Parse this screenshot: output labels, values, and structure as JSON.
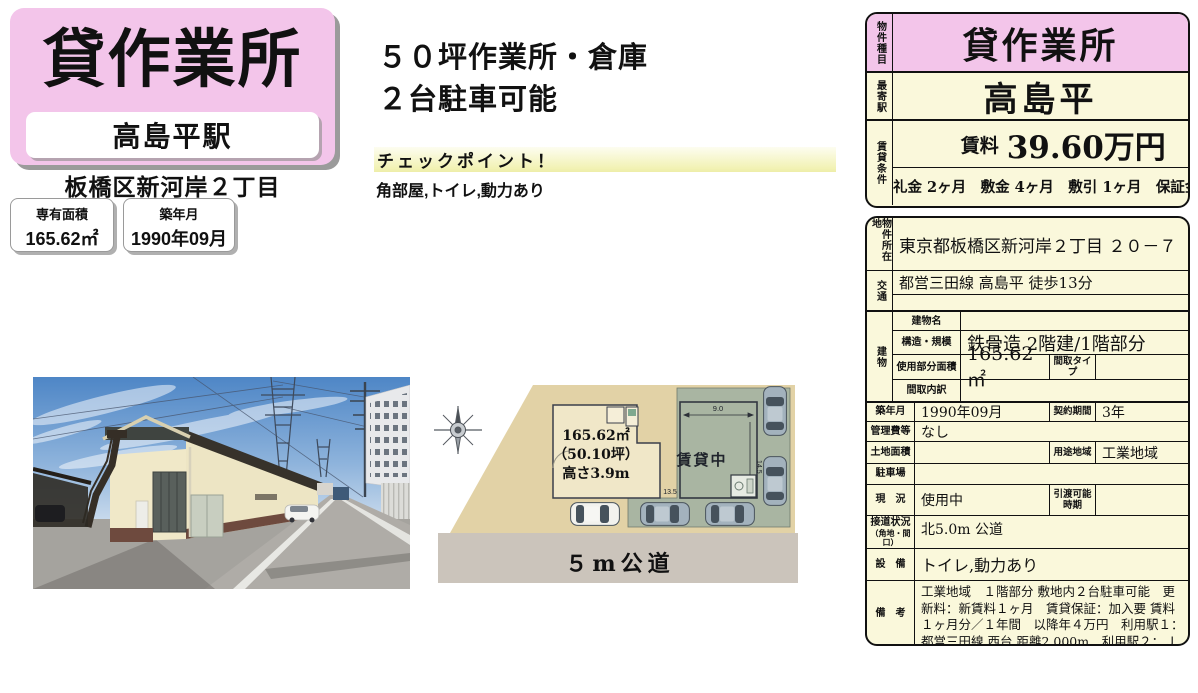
{
  "colors": {
    "pink": "#F3C5EA",
    "cream": "#FAF8DB",
    "checkpoint_yellow": "#F2F2B4",
    "lot_tan": "#E2D2A6",
    "building_green": "#A9B5A2",
    "road_gray": "#CBC4BB"
  },
  "header": {
    "property_type": "貸作業所",
    "station": "高島平駅",
    "address_short": "板橋区新河岸２丁目",
    "area_card": {
      "label": "専有面積",
      "value": "165.62㎡"
    },
    "built_card": {
      "label": "築年月",
      "value": "1990年09月"
    }
  },
  "highlights": {
    "line1": "５０坪作業所・倉庫",
    "line2": "２台駐車可能",
    "checkpoint_title": "チェックポイント！",
    "checkpoint_text": "角部屋,トイレ,動力あり"
  },
  "summary_table": {
    "property_type_label": "物件種目",
    "property_type": "貸作業所",
    "station_label": "最寄駅",
    "station": "高島平",
    "terms_label": "賃貸条件",
    "rent_label": "賃料",
    "rent_value": "39.60万円",
    "terms": "礼金 2ヶ月　敷金 4ヶ月　敷引 1ヶ月　保証金 なし"
  },
  "detail_table": {
    "location": {
      "label": "物件所在地",
      "value": "東京都板橋区新河岸２丁目 ２０－７"
    },
    "access": {
      "label": "交通",
      "value": "都営三田線 高島平 徒歩13分"
    },
    "building": {
      "label": "建物",
      "name_label": "建物名",
      "name": "",
      "structure_label": "構造・規模",
      "structure": "鉄骨造 2階建/1階部分",
      "used_area_label": "使用部分面積",
      "used_area": "165.62㎡",
      "layout_type_label": "間取タイプ",
      "layout_type": "",
      "layout_detail_label": "間取内訳",
      "layout_detail": ""
    },
    "built": {
      "label": "築年月",
      "value": "1990年09月",
      "label2": "契約期間",
      "value2": "3年"
    },
    "management": {
      "label": "管理費等",
      "value": "なし"
    },
    "land": {
      "label": "土地面積",
      "value": "",
      "label2": "用途地域",
      "value2": "工業地域"
    },
    "parking": {
      "label": "駐車場",
      "value": ""
    },
    "status": {
      "label": "現　況",
      "value": "使用中",
      "label2": "引渡可能時期",
      "value2": ""
    },
    "road": {
      "label": "接道状況",
      "label_sub": "（角地・間口）",
      "value": "北5.0m 公道"
    },
    "equipment": {
      "label": "設　備",
      "value": "トイレ,動力あり"
    },
    "notes": {
      "label": "備　考",
      "value": "工業地域　１階部分 敷地内２台駐車可能　更新料：新賃料１ヶ月　賃貸保証：加入要 賃料１ヶ月分／１年間　以降年４万円　利用駅１：都営三田線 西台 距離2,000m　利用駅２：ＪＲ埼京線 浮間舟渡 距離3,100m"
    }
  },
  "site_plan": {
    "area": "165.62㎡",
    "tsubo": "（50.10坪）",
    "height": "高さ3.9m",
    "rented": "賃貸中",
    "dim_top": "9.0",
    "dim_right": "14.5",
    "dim_bottom": "13.5",
    "road_label": "５m公道"
  }
}
